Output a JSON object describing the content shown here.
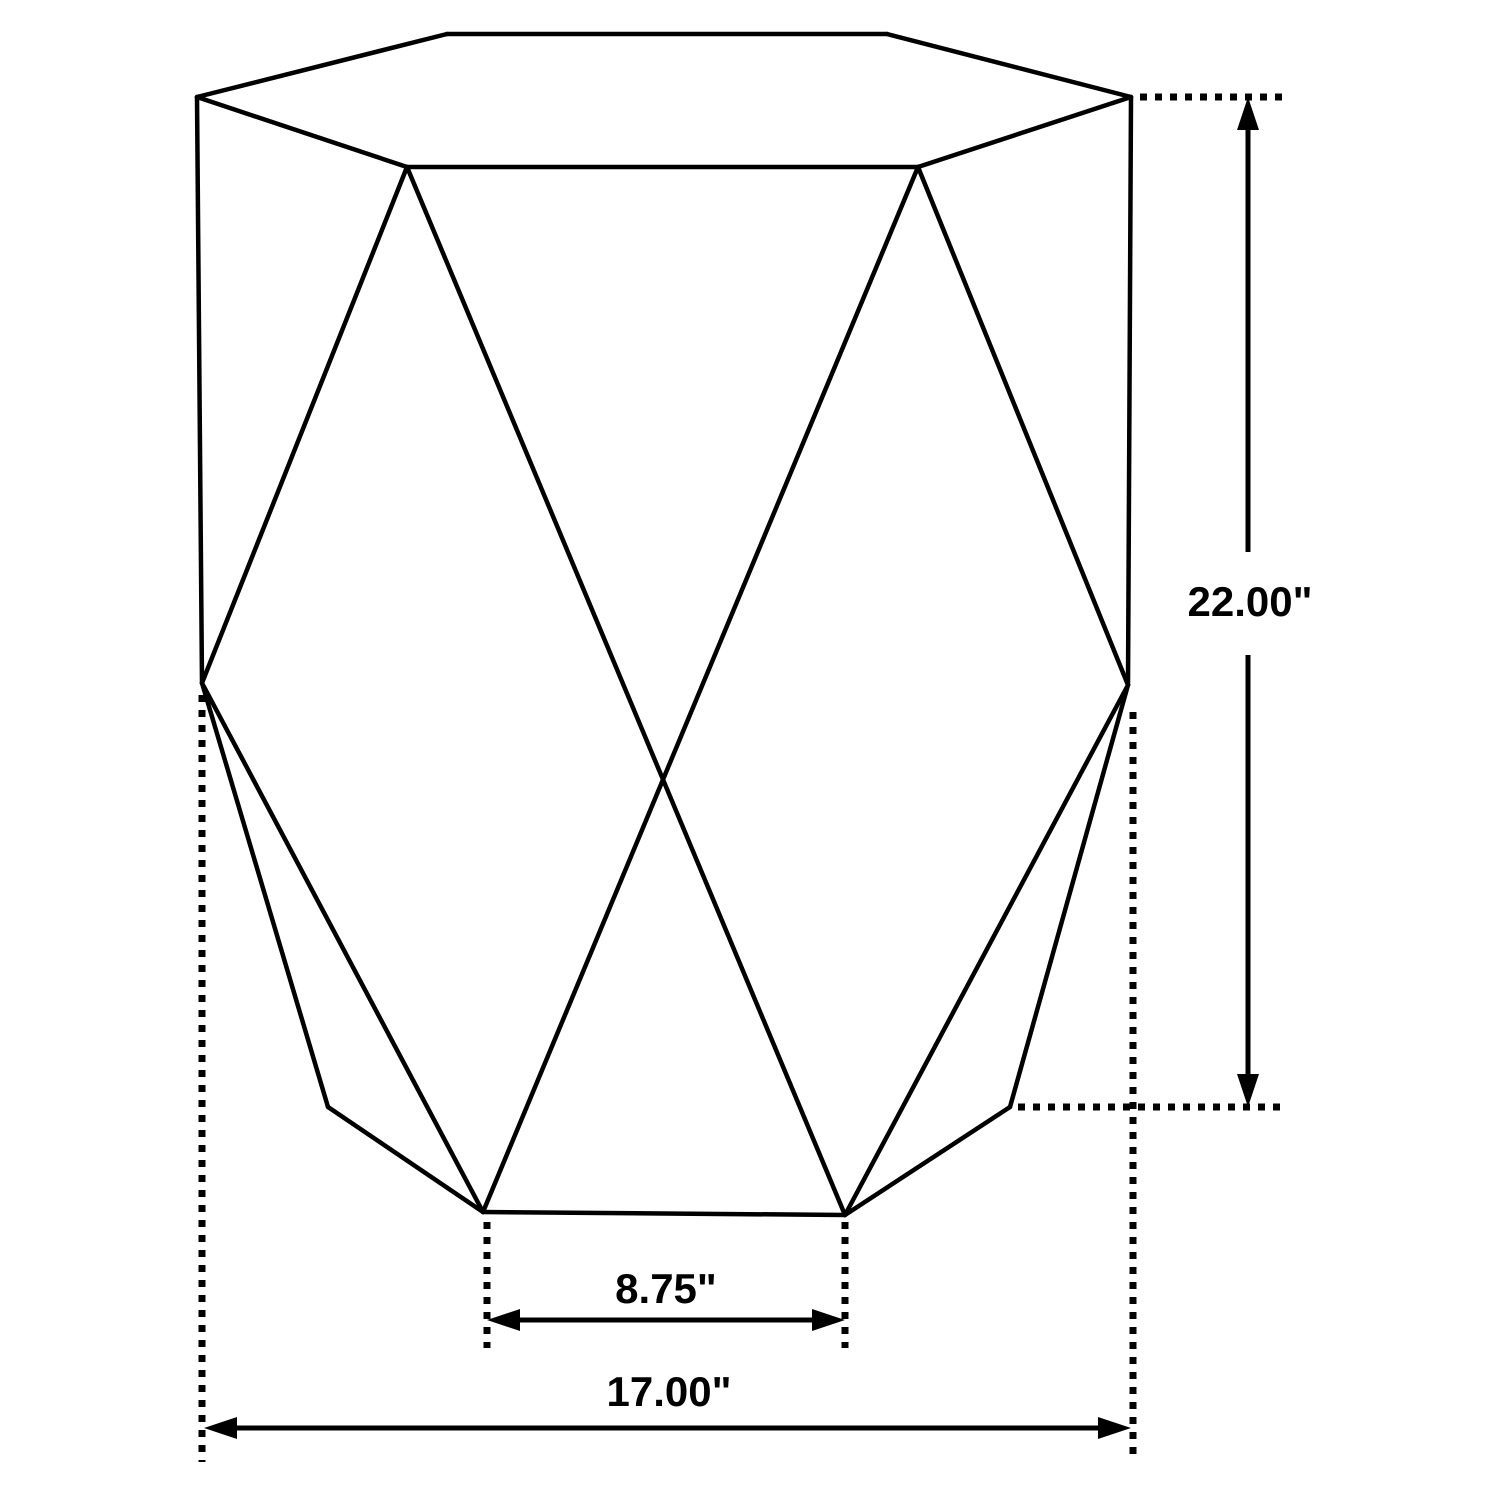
{
  "diagram": {
    "type": "product-dimension-line-drawing",
    "subject": "hexagonal-geometric-accent-table",
    "background_color": "#ffffff",
    "stroke_color": "#000000",
    "dimensions": {
      "height": {
        "label": "22.00\"",
        "value_inches": 22.0
      },
      "base_width": {
        "label": "8.75\"",
        "value_inches": 8.75
      },
      "overall_width": {
        "label": "17.00\"",
        "value_inches": 17.0
      }
    },
    "geometry": {
      "solid_edges": [
        [
          197,
          97,
          447,
          34
        ],
        [
          447,
          34,
          887,
          34
        ],
        [
          887,
          34,
          1131,
          97
        ],
        [
          197,
          97,
          407,
          167
        ],
        [
          407,
          167,
          918,
          167
        ],
        [
          918,
          167,
          1131,
          97
        ],
        [
          197,
          97,
          202,
          683
        ],
        [
          1131,
          97,
          1128,
          685
        ],
        [
          202,
          683,
          328,
          1107
        ],
        [
          328,
          1107,
          483,
          1212
        ],
        [
          483,
          1212,
          845,
          1215
        ],
        [
          845,
          1215,
          1010,
          1107
        ],
        [
          1010,
          1107,
          1128,
          685
        ],
        [
          407,
          167,
          202,
          683
        ],
        [
          918,
          167,
          1128,
          685
        ],
        [
          407,
          167,
          845,
          1215
        ],
        [
          918,
          167,
          483,
          1212
        ],
        [
          202,
          683,
          483,
          1212
        ],
        [
          1128,
          685,
          845,
          1215
        ]
      ],
      "dotted_leaders": [
        [
          202,
          695,
          202,
          1462
        ],
        [
          1133,
          712,
          1133,
          1462
        ],
        [
          487,
          1222,
          487,
          1348
        ],
        [
          845,
          1222,
          845,
          1348
        ],
        [
          1140,
          97,
          1282,
          97
        ],
        [
          1018,
          1107,
          1282,
          1107
        ]
      ],
      "dimension_lines": [
        {
          "name": "height-dimension",
          "orient": "v",
          "at": 1248,
          "from": 97,
          "to": 1107,
          "label_gap": [
            552,
            655
          ]
        },
        {
          "name": "base-width-dimension",
          "orient": "h",
          "at": 1320,
          "from": 487,
          "to": 845
        },
        {
          "name": "overall-width-dimension",
          "orient": "h",
          "at": 1428,
          "from": 204,
          "to": 1131
        }
      ],
      "arrowhead": {
        "length": 33,
        "half_width": 11
      }
    }
  }
}
